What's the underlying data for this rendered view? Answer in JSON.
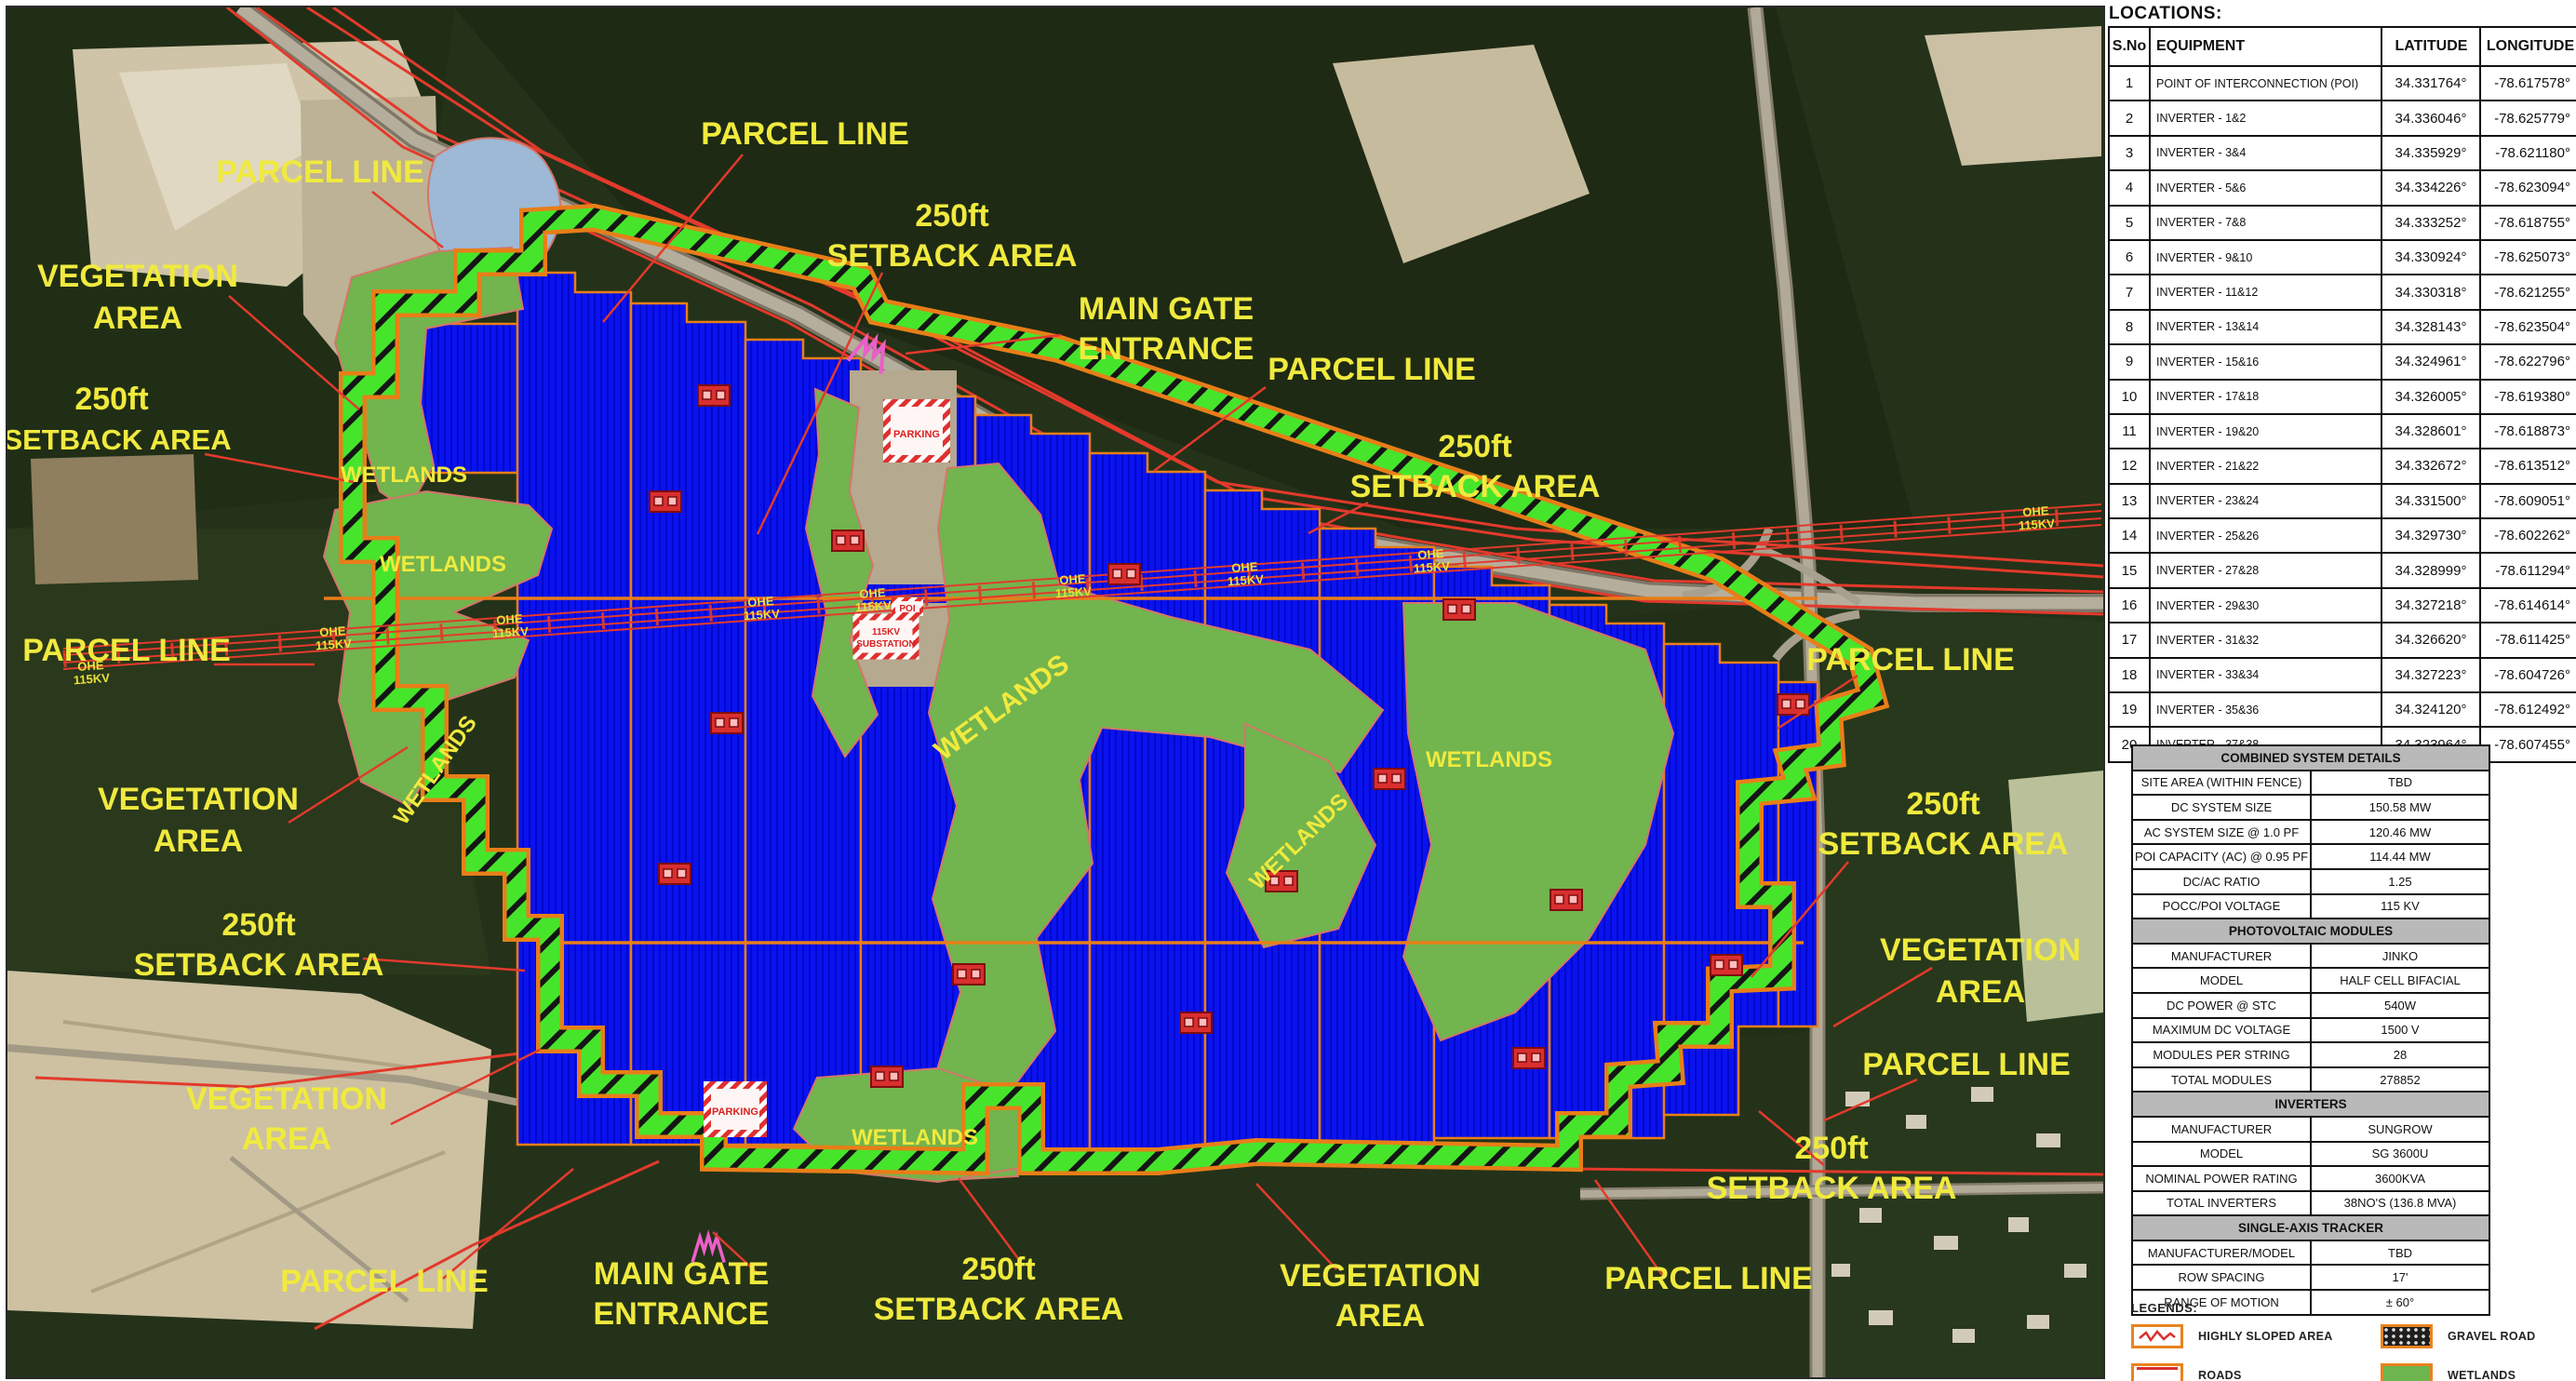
{
  "map": {
    "labels": {
      "parcel_line": "PARCEL LINE",
      "setback_250ft": "250ft",
      "setback_area": "SETBACK AREA",
      "vegetation": "VEGETATION",
      "area": "AREA",
      "main_gate": "MAIN GATE",
      "entrance": "ENTRANCE",
      "wetlands": "WETLANDS",
      "ohe": "OHE",
      "ohe_kv": "115KV",
      "parking": "PARKING",
      "substation_kv": "115KV",
      "substation": "SUBSTATION",
      "poi": "POI"
    },
    "colors": {
      "solar_array_blue": "#0a12f0",
      "wetlands_green": "#72b44e",
      "setback_band_green": "#46e52c",
      "boundary_orange": "#e87e18",
      "parcel_line_red": "#e23a2c",
      "label_yellow": "#f0ea3e"
    }
  },
  "locations": {
    "title": "LOCATIONS:",
    "headers": [
      "S.No",
      "EQUIPMENT",
      "LATITUDE",
      "LONGITUDE"
    ],
    "rows": [
      {
        "sno": "1",
        "equipment": "POINT OF INTERCONNECTION (POI)",
        "lat": "34.331764°",
        "lon": "-78.617578°"
      },
      {
        "sno": "2",
        "equipment": "INVERTER - 1&2",
        "lat": "34.336046°",
        "lon": "-78.625779°"
      },
      {
        "sno": "3",
        "equipment": "INVERTER - 3&4",
        "lat": "34.335929°",
        "lon": "-78.621180°"
      },
      {
        "sno": "4",
        "equipment": "INVERTER - 5&6",
        "lat": "34.334226°",
        "lon": "-78.623094°"
      },
      {
        "sno": "5",
        "equipment": "INVERTER - 7&8",
        "lat": "34.333252°",
        "lon": "-78.618755°"
      },
      {
        "sno": "6",
        "equipment": "INVERTER - 9&10",
        "lat": "34.330924°",
        "lon": "-78.625073°"
      },
      {
        "sno": "7",
        "equipment": "INVERTER - 11&12",
        "lat": "34.330318°",
        "lon": "-78.621255°"
      },
      {
        "sno": "8",
        "equipment": "INVERTER - 13&14",
        "lat": "34.328143°",
        "lon": "-78.623504°"
      },
      {
        "sno": "9",
        "equipment": "INVERTER - 15&16",
        "lat": "34.324961°",
        "lon": "-78.622796°"
      },
      {
        "sno": "10",
        "equipment": "INVERTER - 17&18",
        "lat": "34.326005°",
        "lon": "-78.619380°"
      },
      {
        "sno": "11",
        "equipment": "INVERTER - 19&20",
        "lat": "34.328601°",
        "lon": "-78.618873°"
      },
      {
        "sno": "12",
        "equipment": "INVERTER - 21&22",
        "lat": "34.332672°",
        "lon": "-78.613512°"
      },
      {
        "sno": "13",
        "equipment": "INVERTER - 23&24",
        "lat": "34.331500°",
        "lon": "-78.609051°"
      },
      {
        "sno": "14",
        "equipment": "INVERTER - 25&26",
        "lat": "34.329730°",
        "lon": "-78.602262°"
      },
      {
        "sno": "15",
        "equipment": "INVERTER - 27&28",
        "lat": "34.328999°",
        "lon": "-78.611294°"
      },
      {
        "sno": "16",
        "equipment": "INVERTER - 29&30",
        "lat": "34.327218°",
        "lon": "-78.614614°"
      },
      {
        "sno": "17",
        "equipment": "INVERTER - 31&32",
        "lat": "34.326620°",
        "lon": "-78.611425°"
      },
      {
        "sno": "18",
        "equipment": "INVERTER - 33&34",
        "lat": "34.327223°",
        "lon": "-78.604726°"
      },
      {
        "sno": "19",
        "equipment": "INVERTER - 35&36",
        "lat": "34.324120°",
        "lon": "-78.612492°"
      },
      {
        "sno": "20",
        "equipment": "INVERTER - 37&38",
        "lat": "34.323964°",
        "lon": "-78.607455°"
      }
    ]
  },
  "system_details": {
    "sections": [
      {
        "title": "COMBINED SYSTEM DETAILS",
        "rows": [
          [
            "SITE AREA (WITHIN FENCE)",
            "TBD"
          ],
          [
            "DC SYSTEM SIZE",
            "150.58 MW"
          ],
          [
            "AC SYSTEM SIZE @ 1.0 PF",
            "120.46 MW"
          ],
          [
            "POI CAPACITY (AC) @ 0.95 PF",
            "114.44 MW"
          ],
          [
            "DC/AC RATIO",
            "1.25"
          ],
          [
            "POCC/POI VOLTAGE",
            "115 KV"
          ]
        ]
      },
      {
        "title": "PHOTOVOLTAIC MODULES",
        "rows": [
          [
            "MANUFACTURER",
            "JINKO"
          ],
          [
            "MODEL",
            "HALF CELL BIFACIAL"
          ],
          [
            "DC POWER @ STC",
            "540W"
          ],
          [
            "MAXIMUM DC VOLTAGE",
            "1500 V"
          ],
          [
            "MODULES PER STRING",
            "28"
          ],
          [
            "TOTAL MODULES",
            "278852"
          ]
        ]
      },
      {
        "title": "INVERTERS",
        "rows": [
          [
            "MANUFACTURER",
            "SUNGROW"
          ],
          [
            "MODEL",
            "SG 3600U"
          ],
          [
            "NOMINAL POWER RATING",
            "3600KVA"
          ],
          [
            "TOTAL INVERTERS",
            "38NO'S (136.8 MVA)"
          ]
        ]
      },
      {
        "title": "SINGLE-AXIS TRACKER",
        "rows": [
          [
            "MANUFACTURER/MODEL",
            "TBD"
          ],
          [
            "ROW SPACING",
            "17'"
          ],
          [
            "RANGE OF MOTION",
            "± 60°"
          ]
        ]
      }
    ]
  },
  "legends": {
    "title": "LEGENDS:",
    "items": [
      {
        "label": "HIGHLY SLOPED AREA"
      },
      {
        "label": "GRAVEL ROAD"
      },
      {
        "label": "ROADS"
      },
      {
        "label": "WETLANDS"
      }
    ]
  }
}
